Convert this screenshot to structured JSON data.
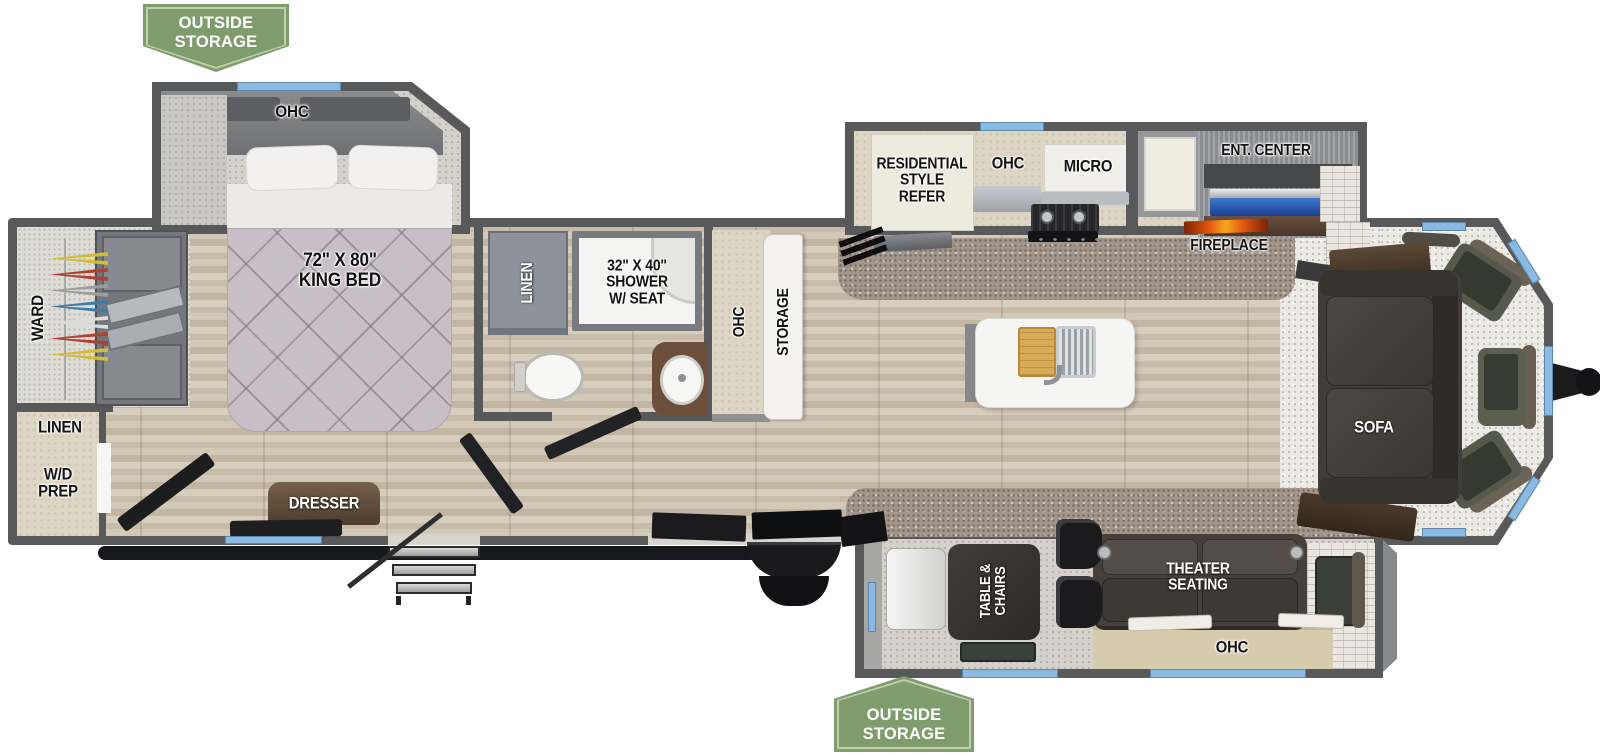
{
  "colors": {
    "banner_green": "#7f9c6d",
    "window_blue": "#8ab9e2",
    "wall_gray": "#58595b",
    "flame_orange": "#e4570e",
    "tv_blue": "#2f66bd"
  },
  "banners": {
    "top": "OUTSIDE\nSTORAGE",
    "bottom": "OUTSIDE\nSTORAGE"
  },
  "bedroom": {
    "ohc": "OHC",
    "king_bed": "72\" X 80\"\nKING BED",
    "dresser": "DRESSER"
  },
  "left_end": {
    "ward": "WARD",
    "linen": "LINEN",
    "wd_prep": "W/D\nPREP"
  },
  "bathroom": {
    "linen": "LINEN",
    "shower": "32\" X 40\"\nSHOWER\nW/ SEAT"
  },
  "hallway": {
    "ohc": "OHC",
    "storage": "STORAGE"
  },
  "kitchen": {
    "refer": "RESIDENTIAL\nSTYLE\nREFER",
    "ohc": "OHC",
    "micro": "MICRO"
  },
  "living": {
    "ent_center": "ENT. CENTER",
    "fireplace": "FIREPLACE",
    "sofa": "SOFA"
  },
  "dinette": {
    "table_chairs": "TABLE &\nCHAIRS",
    "theater": "THEATER\nSEATING",
    "ohc": "OHC"
  }
}
